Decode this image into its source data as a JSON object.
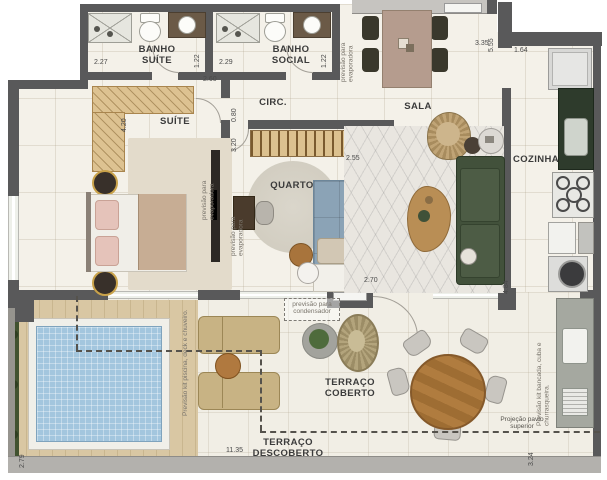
{
  "plan": {
    "rooms": {
      "banho_suite": "BANHO SUÍTE",
      "banho_social": "BANHO SOCIAL",
      "circ": "CIRC.",
      "sala": "SALA",
      "suite": "SUÍTE",
      "quarto": "QUARTO",
      "cozinha": "COZINHA",
      "terraco_coberto": "TERRAÇO COBERTO",
      "terraco_descoberto": "TERRAÇO DESCOBERTO"
    },
    "dimensions": {
      "banho_suite_width": "2.27",
      "banho_suite_depth": "1.22",
      "banho_social_width": "2.29",
      "banho_social_depth": "1.22",
      "circ_width": "2.60",
      "sala_height": "5.55",
      "sala_width": "3.35",
      "cozinha_width": "1.64",
      "suite_height": "4.20",
      "suite_door": "0.80",
      "quarto_height": "3.20",
      "quarto_width_top": "2.55",
      "quarto_width_bottom": "2.70",
      "cozinha_height": "4.84",
      "deck_depth": "2.79",
      "terraco_width": "11.35",
      "terraco_height": "3.24"
    },
    "notes": {
      "evaporadora_sala": "previsão para evaporadora",
      "evaporadora_suite": "previsão para evaporadora",
      "evaporadora_quarto": "previsão para evaporadora",
      "condensador": "previsão para condensador",
      "kit_piscina": "Previsão kit piscina, deck e chuveiro.",
      "kit_bancada": "Previsão kit bancada, cuba e churrasqueira.",
      "projecao": "Projeção pavto superior"
    },
    "colors": {
      "wall": "#59595a",
      "floor": "#f4f1e9",
      "deck": "#d6c29c",
      "pool_water": "#a3c6de",
      "sofa": "#42513b",
      "granite_dark": "#2e3b2c",
      "wood": "#b07c3f",
      "bed_blue": "#8ba3b6",
      "pillow_pink": "#e5c3ba"
    }
  }
}
